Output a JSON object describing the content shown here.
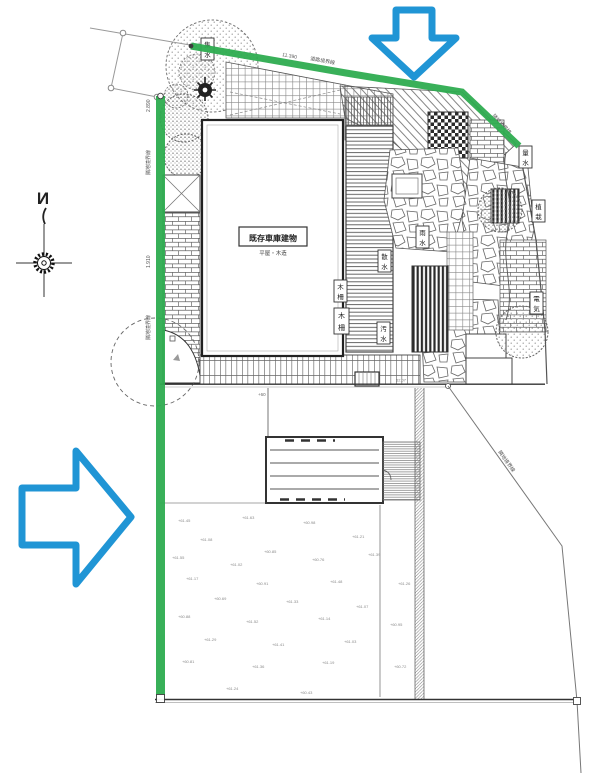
{
  "colors": {
    "highlight_green": "#2EAC50",
    "arrow_blue": "#2095D5",
    "line_dark": "#333333",
    "line_mid": "#666666",
    "text_gray": "#8a8a8a"
  },
  "compass": {
    "label": "N"
  },
  "building": {
    "name": "既存車庫建物",
    "sub": "平屋・木造"
  },
  "boundary_labels": {
    "left_upper": "隣地境界線",
    "left_upper_dim": "2.890",
    "left_lower": "隣地境界線",
    "left_lower_dim": "1.910",
    "top_dim": "11.390",
    "top": "道路境界線",
    "top_right": "隣地境界線",
    "right": "隣地境界線",
    "bottom_plus": "+60",
    "bottom_dim": "62.07"
  },
  "deck_label": "木柵",
  "equipment_boxes": {
    "labels": [
      "集水",
      "雨水",
      "散水",
      "木柵",
      "汚水",
      "量水",
      "植栽",
      "電気"
    ]
  },
  "spot_elevations": {
    "values": [
      "+61.45",
      "+61.63",
      "+60.98",
      "+61.21",
      "+61.08",
      "+60.85",
      "+61.55",
      "+61.02",
      "+60.76",
      "+61.39",
      "+61.17",
      "+60.91",
      "+61.48",
      "+61.26",
      "+60.69",
      "+61.33",
      "+61.07",
      "+60.88",
      "+61.52",
      "+61.14",
      "+60.95",
      "+61.29",
      "+61.41",
      "+61.03",
      "+60.81",
      "+61.36",
      "+61.19",
      "+60.72",
      "+60.43",
      "+61.24"
    ]
  },
  "icons": {
    "top_annotation": "arrow-down",
    "left_annotation": "arrow-right"
  }
}
